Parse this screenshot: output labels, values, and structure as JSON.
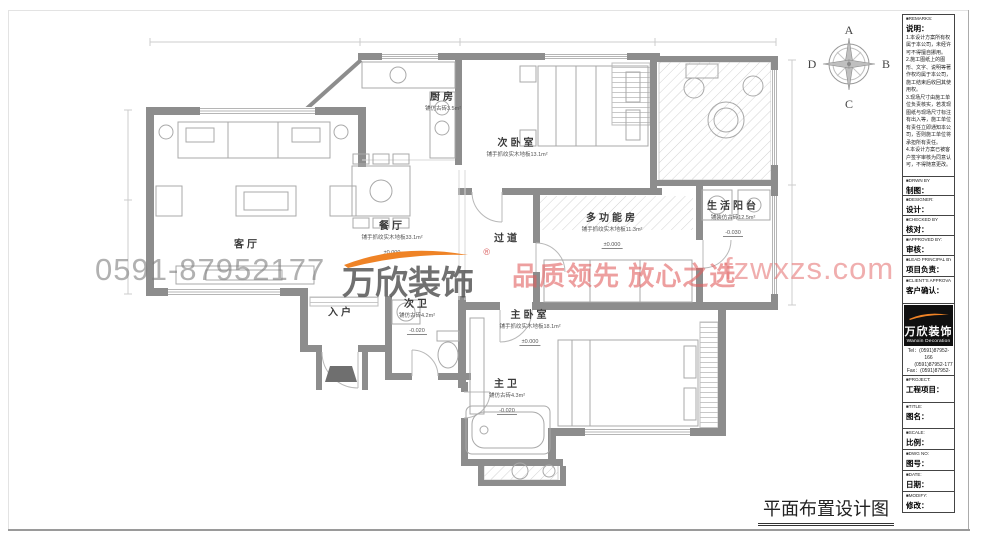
{
  "page": {
    "plan_title": "平面布置设计图"
  },
  "compass": {
    "top": "A",
    "right": "B",
    "bottom": "C",
    "left": "D"
  },
  "watermark": {
    "phone": "0591-87952177",
    "brand": "万欣装饰",
    "reg_mark": "®",
    "slogan": "品质领先 放心之选",
    "website": "fzwxzs.com"
  },
  "rooms": [
    {
      "name": "厨房",
      "note": "铺仿古砖3.5m²",
      "elev": "",
      "x": 443,
      "y": 100
    },
    {
      "name": "次卧室",
      "note": "铺手抓纹实木地板13.1m²",
      "elev": "",
      "x": 517,
      "y": 146
    },
    {
      "name": "客厅",
      "note": "",
      "elev": "",
      "x": 247,
      "y": 243
    },
    {
      "name": "餐厅",
      "note": "铺手抓纹实木地板33.1m²",
      "elev": "±0.000",
      "x": 392,
      "y": 238
    },
    {
      "name": "过道",
      "note": "",
      "elev": "",
      "x": 507,
      "y": 237
    },
    {
      "name": "多功能房",
      "note": "铺手抓纹实木地板11.3m²",
      "elev": "±0.000",
      "x": 612,
      "y": 230
    },
    {
      "name": "生活阳台",
      "note": "铺装仿古砖12.5m²",
      "elev": "-0.030",
      "x": 733,
      "y": 218
    },
    {
      "name": "入户",
      "note": "",
      "elev": "",
      "x": 341,
      "y": 311
    },
    {
      "name": "次卫",
      "note": "铺仿古砖4.2m²",
      "elev": "-0.020",
      "x": 417,
      "y": 316
    },
    {
      "name": "主卧室",
      "note": "铺手抓纹实木地板18.1m²",
      "elev": "±0.000",
      "x": 530,
      "y": 327
    },
    {
      "name": "主卫",
      "note": "铺仿古砖4.3m²",
      "elev": "-0.020",
      "x": 507,
      "y": 396
    }
  ],
  "titleblock": {
    "remarks": {
      "caption": "■REMARKS:",
      "label": "说明：",
      "body": "1.本设计方案所有权属于本公司，未经许可不得擅自挪用。\n2.施工图纸上的图形、文字、说明等著作权均属于本公司，施工结束后收回其使用权。\n3.现场尺寸由施工单位负责核实，若发现图纸与现场尺寸标注有出入等，施工单位有责任立即通知本公司，否则施工单位将承担所有责任。\n4.本设计方案已被客户签字审核为同意认可，不得随意更改。"
    },
    "fields": [
      {
        "caption": "■DRWN BY",
        "label": "制图："
      },
      {
        "caption": "■DESIGNER:",
        "label": "设计："
      },
      {
        "caption": "■CHECKED BY",
        "label": "核对："
      },
      {
        "caption": "■APPROVED BY:",
        "label": "审核："
      },
      {
        "caption": "■LEAD PRINCIPAL BY:",
        "label": "项目负责："
      },
      {
        "caption": "■CLIENT'S APPROVAL:",
        "label": "客户确认："
      }
    ],
    "brand": {
      "logo_text": "万欣装饰",
      "logo_sub": "Wanxin Decoration",
      "contact_lines": [
        "Tel：(0591)87952-166",
        "　　(0591)87952-177",
        "Fax：(0591)87952-198",
        "Web：WWW.fzwxzs.com"
      ]
    },
    "fields2": [
      {
        "caption": "■PROJECT:",
        "label": "工程项目："
      },
      {
        "caption": "■TITLE:",
        "label": "图名："
      },
      {
        "caption": "■SCALE:",
        "label": "比例："
      },
      {
        "caption": "■DWG NO:",
        "label": "图号："
      },
      {
        "caption": "■DATE:",
        "label": "日期："
      },
      {
        "caption": "■MODIFY:",
        "label": "修改："
      }
    ]
  }
}
